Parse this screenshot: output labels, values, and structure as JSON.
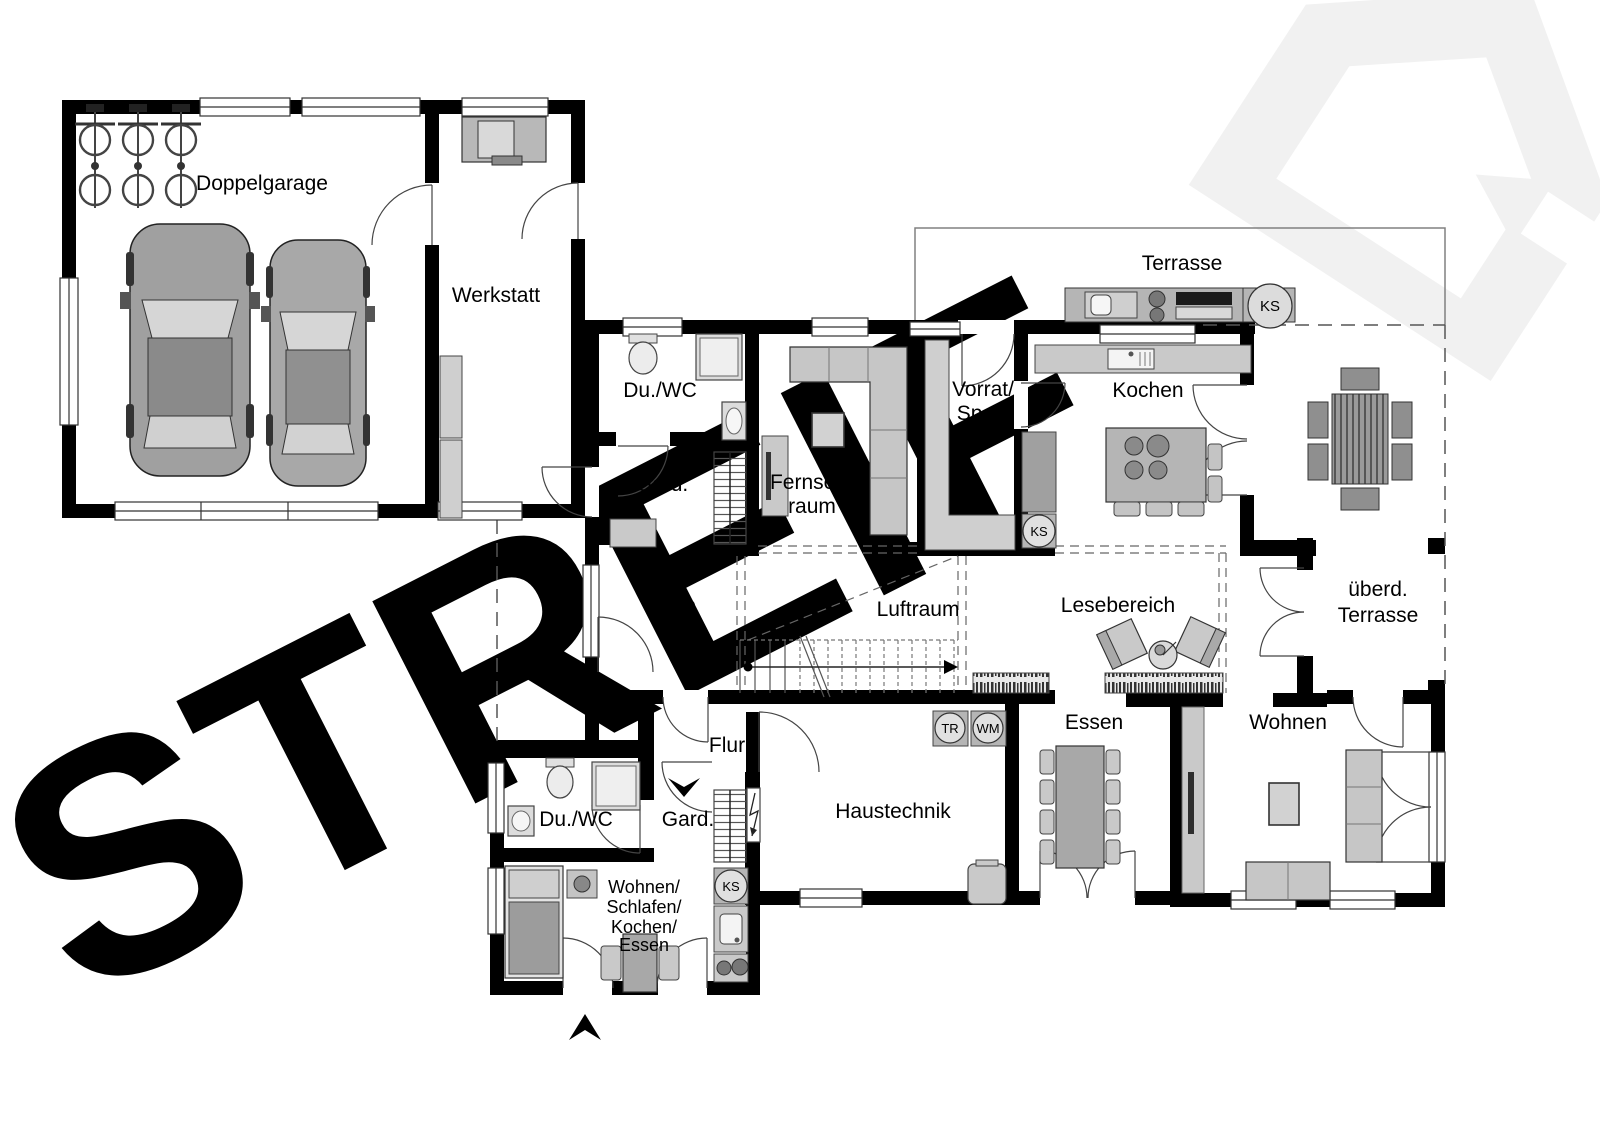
{
  "watermark": {
    "brand": "STREIF"
  },
  "rooms": {
    "doppelgarage": "Doppelgarage",
    "werkstatt": "Werkstatt",
    "du_wc_eg": "Du./WC",
    "gard_eg": "Gard.",
    "fernsehraum": [
      "Fernseh-",
      "raum"
    ],
    "vorrat": [
      "Vorrat/",
      "Speis"
    ],
    "kochen": "Kochen",
    "terrasse": "Terrasse",
    "diele": "Diele",
    "luftraum": "Luftraum",
    "lesebereich": "Lesebereich",
    "ueberdachte_terrasse": [
      "überd.",
      "Terrasse"
    ],
    "flur": "Flur",
    "haustechnik": "Haustechnik",
    "essen": "Essen",
    "wohnen": "Wohnen",
    "du_wc_apartment": "Du./WC",
    "gard_apartment": "Gard.",
    "apartment": [
      "Wohnen/",
      "Schlafen/",
      "Kochen/",
      "Essen"
    ]
  },
  "appliances": {
    "ks": "KS",
    "tr": "TR",
    "wm": "WM"
  },
  "colors": {
    "wall": "#000000",
    "furniture_light": "#c9c9c9",
    "furniture_mid": "#b5b5b5",
    "watermark": "#ededed"
  }
}
